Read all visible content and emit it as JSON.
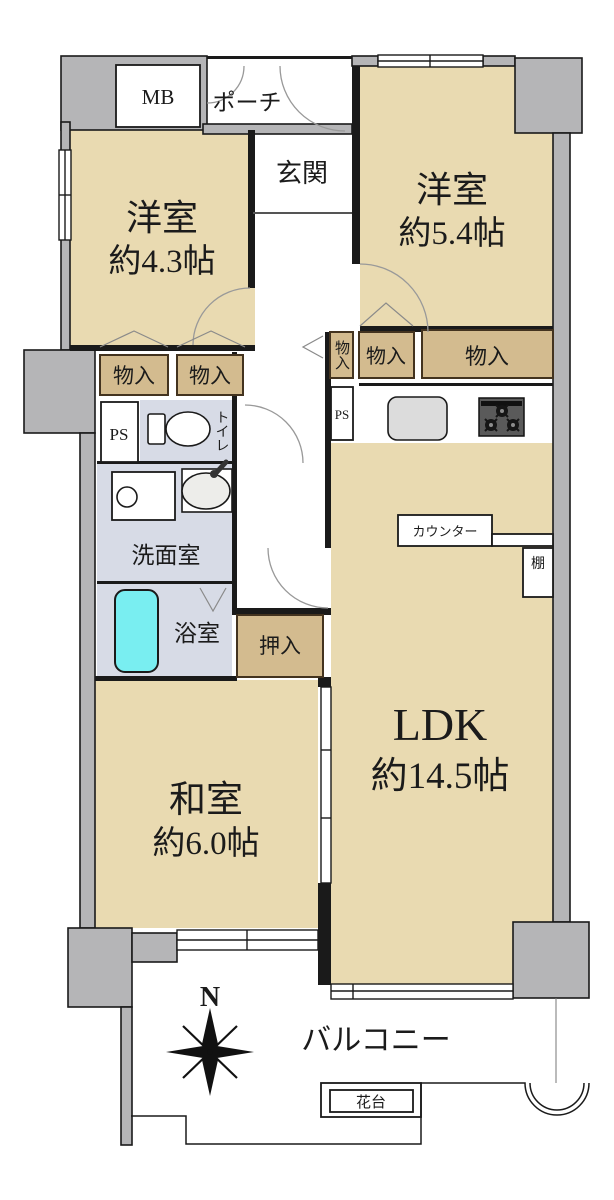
{
  "floorplan": {
    "rooms": {
      "western1": {
        "name": "洋室",
        "size": "約4.3帖"
      },
      "western2": {
        "name": "洋室",
        "size": "約5.4帖"
      },
      "ldk": {
        "name": "LDK",
        "size": "約14.5帖"
      },
      "japanese": {
        "name": "和室",
        "size": "約6.0帖"
      },
      "entrance": "玄関",
      "porch": "ポーチ",
      "washroom": "洗面室",
      "bathroom": "浴室",
      "toilet": "トイレ",
      "closet": "押入",
      "balcony": "バルコニー"
    },
    "labels": {
      "mb": "MB",
      "ps": "PS",
      "storage": "物入",
      "counter": "カウンター",
      "shelf": "棚",
      "flower_stand": "花台",
      "north": "N"
    },
    "colors": {
      "room_beige": "#E9DAB1",
      "storage_tan": "#D3BB8F",
      "storage_border": "#43331F",
      "wet_area": "#D7DBE6",
      "wall_gray": "#B5B5B7",
      "outline": "#1A1A1A",
      "bathtub": "#79EEF1"
    }
  }
}
